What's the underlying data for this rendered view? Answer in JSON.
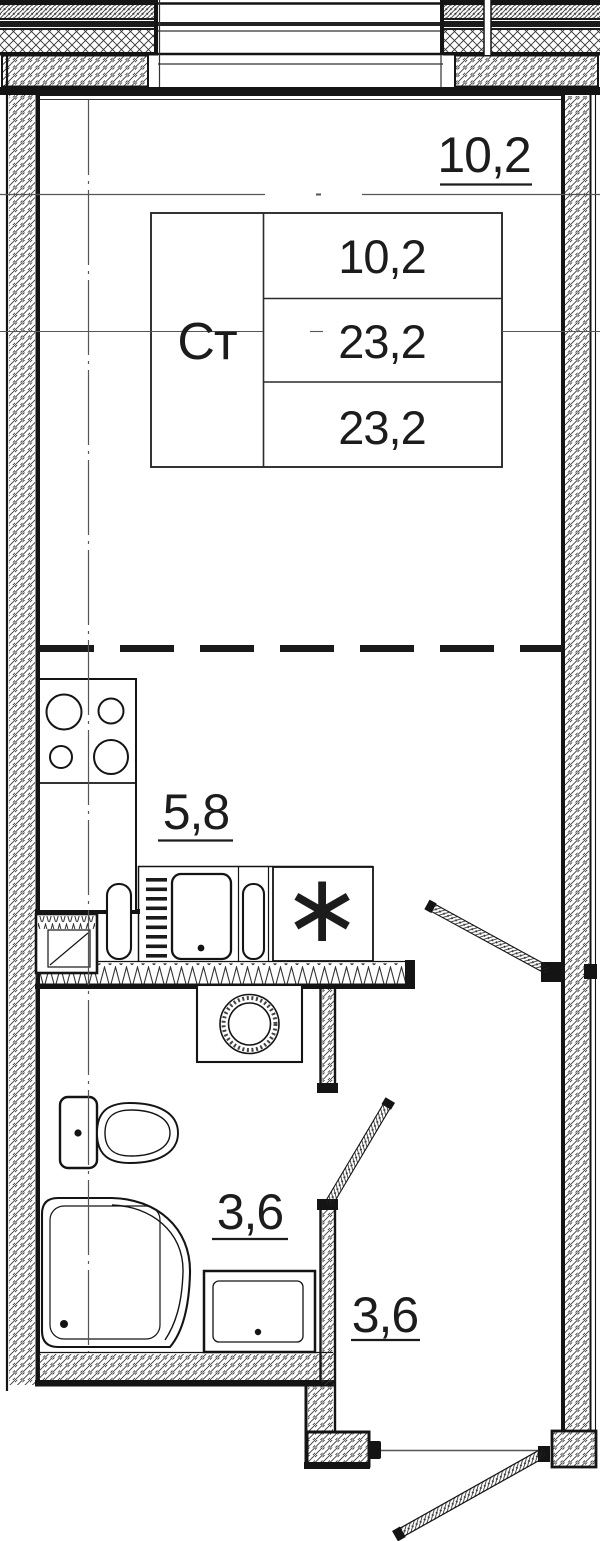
{
  "unit_card": {
    "type_label": "Ст",
    "row_values": [
      "10,2",
      "23,2",
      "23,2"
    ]
  },
  "room_labels": {
    "living_area": "10,2",
    "kitchen_area": "5,8",
    "bathroom_area": "3,6",
    "hall_area": "3,6"
  },
  "symbols": {
    "fridge_asterisk": "∗"
  },
  "palette": {
    "line": "#141414",
    "hatch": "#3c3c3c",
    "background": "#ffffff"
  }
}
